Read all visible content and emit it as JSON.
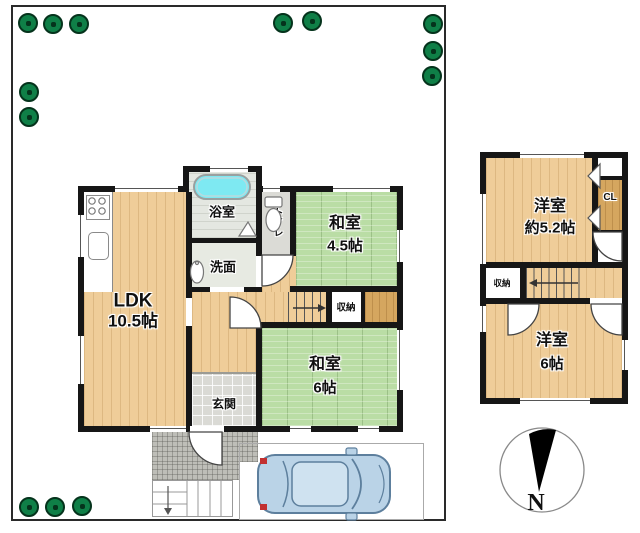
{
  "floor1": {
    "ldk": {
      "name": "LDK",
      "size": "10.5帖"
    },
    "bath": "浴室",
    "washroom": "洗面",
    "toilet": "トイレ",
    "entrance": "玄関",
    "storage": "収納",
    "washitsu_45": {
      "name": "和室",
      "size": "4.5帖"
    },
    "washitsu_6": {
      "name": "和室",
      "size": "6帖"
    }
  },
  "floor2": {
    "yoshitsu_52": {
      "name": "洋室",
      "size": "約5.2帖"
    },
    "yoshitsu_6": {
      "name": "洋室",
      "size": "6帖"
    },
    "storage": "収納",
    "closet": "CL"
  },
  "compass": {
    "north": "N"
  },
  "colors": {
    "wall": "#161616",
    "wood_floor": "#efcd99",
    "tatami": "#badda5",
    "tub": "#7ee9f2",
    "tree": "#0f7f47",
    "car_body": "#bad3e7"
  }
}
